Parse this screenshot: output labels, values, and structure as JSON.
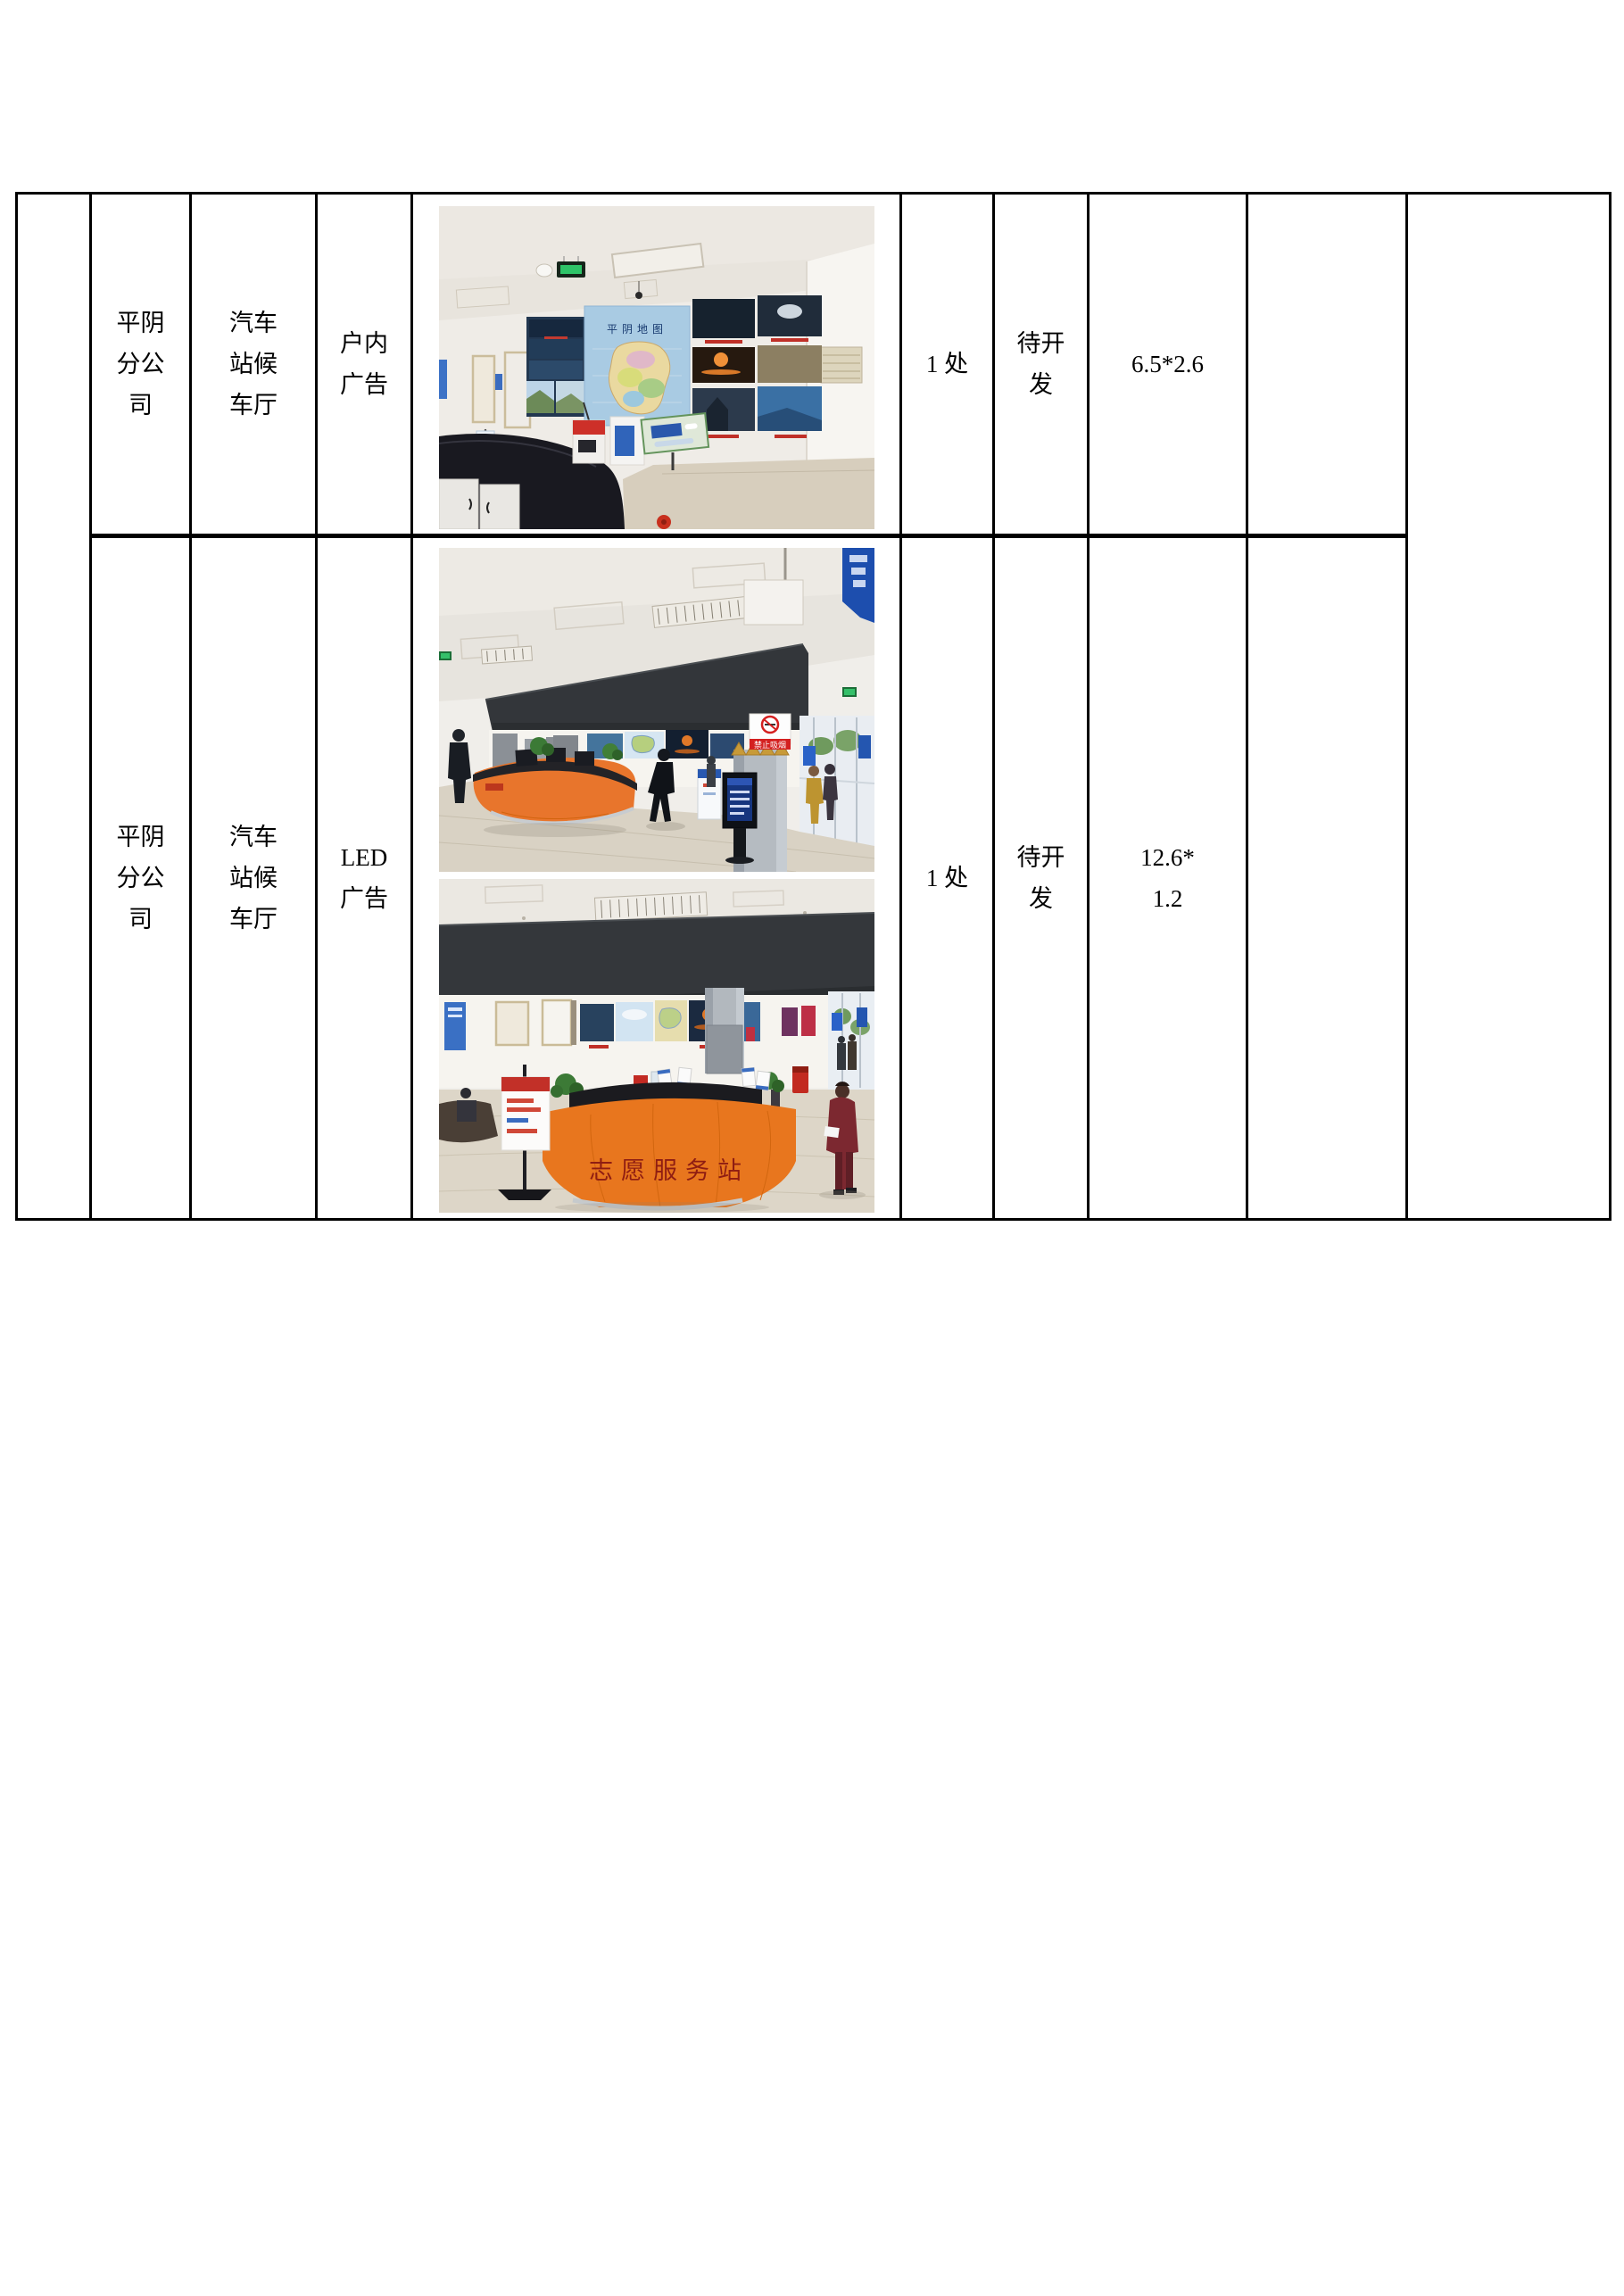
{
  "page": {
    "background": "#ffffff"
  },
  "colors": {
    "table_border": "#000000",
    "desk_orange": "#e8761e",
    "fascia_dark": "#34373b",
    "map_poster_blue": "#a9cbe3",
    "sign_red": "#d42020"
  },
  "table": {
    "rows": [
      {
        "company": "平阴分公司",
        "location": "汽车站候车厅",
        "ad_type": "户内广告",
        "quantity": "1 处",
        "status": "待开发",
        "size": "6.5*2.6",
        "photo": {
          "name": "waiting-hall-map-wall",
          "map_title": "平阴地图"
        }
      },
      {
        "company": "平阴分公司",
        "location": "汽车站候车厅",
        "ad_type": "LED广告",
        "quantity": "1 处",
        "status": "待开发",
        "size": "12.6*\n1.2",
        "photos": [
          {
            "name": "hall-info-desk",
            "sign_text": "禁止吸烟"
          },
          {
            "name": "volunteer-service-desk",
            "desk_text": "志愿服务站"
          }
        ]
      }
    ]
  }
}
